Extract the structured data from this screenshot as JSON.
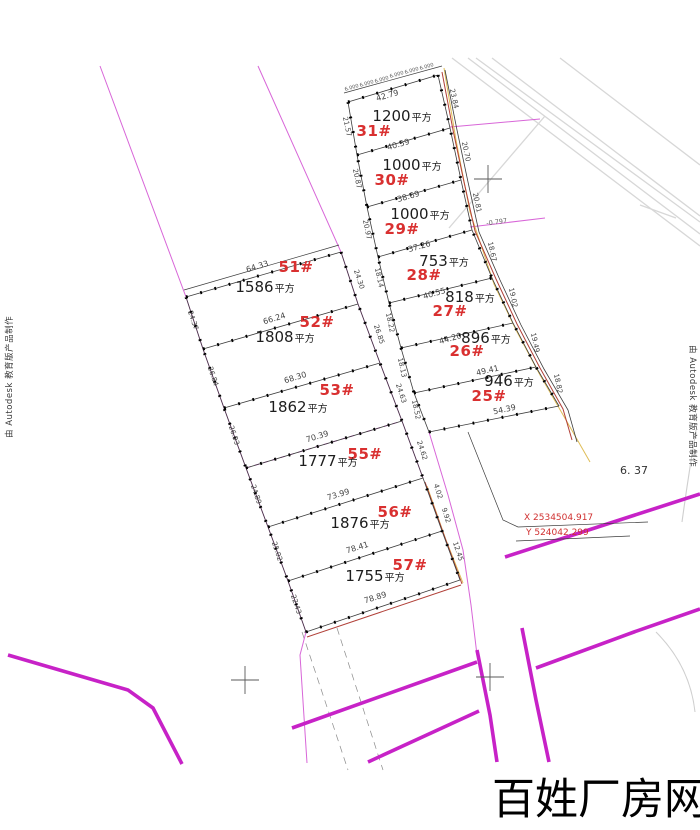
{
  "watermark": "百姓厂房网",
  "edu_stamp": "由 Autodesk 教育版产品制作",
  "survey_point": {
    "x_label": "X 2534504.917",
    "y_label": "Y 524042.299"
  },
  "misc": {
    "elevation": "6. 37",
    "offset_note": "-0.797",
    "unit_suffix": "平方"
  },
  "left_group": {
    "parcels": [
      {
        "id": "51#",
        "area": "1586",
        "top_dim": "64.33",
        "bottom_dim": "66.24",
        "left_dim": "24.37",
        "right_dim": "24.30"
      },
      {
        "id": "52#",
        "area": "1808",
        "bottom_dim": "68.30",
        "left_dim": "26.84",
        "right_dim": "26.85"
      },
      {
        "id": "53#",
        "area": "1862",
        "bottom_dim": "70.39",
        "left_dim": "26.93",
        "right_dim": "24.63"
      },
      {
        "id": "55#",
        "area": "1777",
        "bottom_dim": "73.99",
        "left_dim": "24.89",
        "right_dim": "24.62"
      },
      {
        "id": "56#",
        "area": "1876",
        "bottom_dim": "78.41",
        "left_dim": "25.02",
        "right_dim": "9.92",
        "right_dim2": "4.02",
        "right_dim3": "12.45"
      },
      {
        "id": "57#",
        "area": "1755",
        "bottom_dim": "78.89",
        "left_dim": "22.43"
      }
    ]
  },
  "right_group": {
    "parcels": [
      {
        "id": "31#",
        "area": "1200",
        "top_dim": "42.79",
        "bottom_dim": "40.59",
        "left_dim": "21.57",
        "right_dim": "23.84"
      },
      {
        "id": "30#",
        "area": "1000",
        "bottom_dim": "38.69",
        "left_dim": "20.87",
        "right_dim": "20.70"
      },
      {
        "id": "29#",
        "area": "1000",
        "bottom_dim": "37.26",
        "left_dim": "20.97",
        "right_dim": "20.81"
      },
      {
        "id": "28#",
        "area": "753",
        "bottom_dim": "40.55",
        "left_dim": "18.14",
        "right_dim": "18.67"
      },
      {
        "id": "27#",
        "area": "818",
        "bottom_dim": "44.20",
        "left_dim": "18.22",
        "right_dim": "19.02"
      },
      {
        "id": "26#",
        "area": "896",
        "bottom_dim": "49.41",
        "left_dim": "18.13",
        "right_dim": "19.49"
      },
      {
        "id": "25#",
        "area": "946",
        "bottom_dim": "54.39",
        "left_dim": "18.52",
        "right_dim": "18.82"
      }
    ],
    "top_segments": [
      "6.000",
      "6.000",
      "6.000",
      "6.000",
      "6.000",
      "6.000"
    ]
  },
  "colors": {
    "road_magenta": "#c722c7",
    "boundary_magenta": "#d866d8",
    "parcel_number_red": "#d93030",
    "boundary_red": "#b14038",
    "reference_yellow": "#dfbd58",
    "survey_line": "#3c3c3c",
    "background_roads_gray": "#d7d7d7"
  }
}
